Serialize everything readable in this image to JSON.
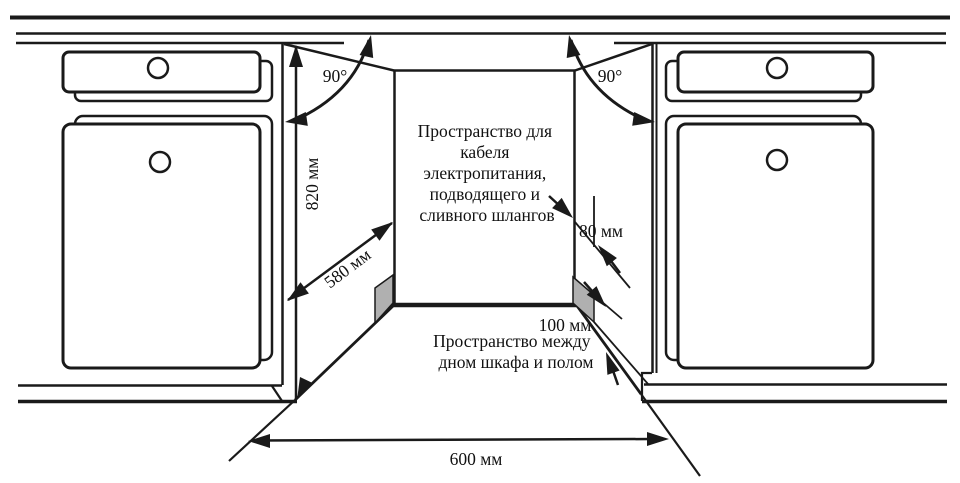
{
  "diagram": {
    "title": "built-in appliance niche installation diagram",
    "colors": {
      "line": "#1a1a1a",
      "cutout_gray": "#b0b0b0",
      "background": "#ffffff"
    },
    "labels": {
      "angle_left": "90°",
      "angle_right": "90°",
      "niche_height": "820 мм",
      "niche_depth": "580 мм",
      "hose_space": "80 мм",
      "floor_space": "100 мм",
      "niche_width": "600 мм"
    },
    "notes": {
      "cable_note": {
        "line1": "Пространство для",
        "line2": "кабеля",
        "line3": "электропитания,",
        "line4": "подводящего и",
        "line5": "сливного шлангов"
      },
      "floor_note": {
        "line1": "Пространство между",
        "line2": "дном шкафа и полом"
      }
    }
  }
}
